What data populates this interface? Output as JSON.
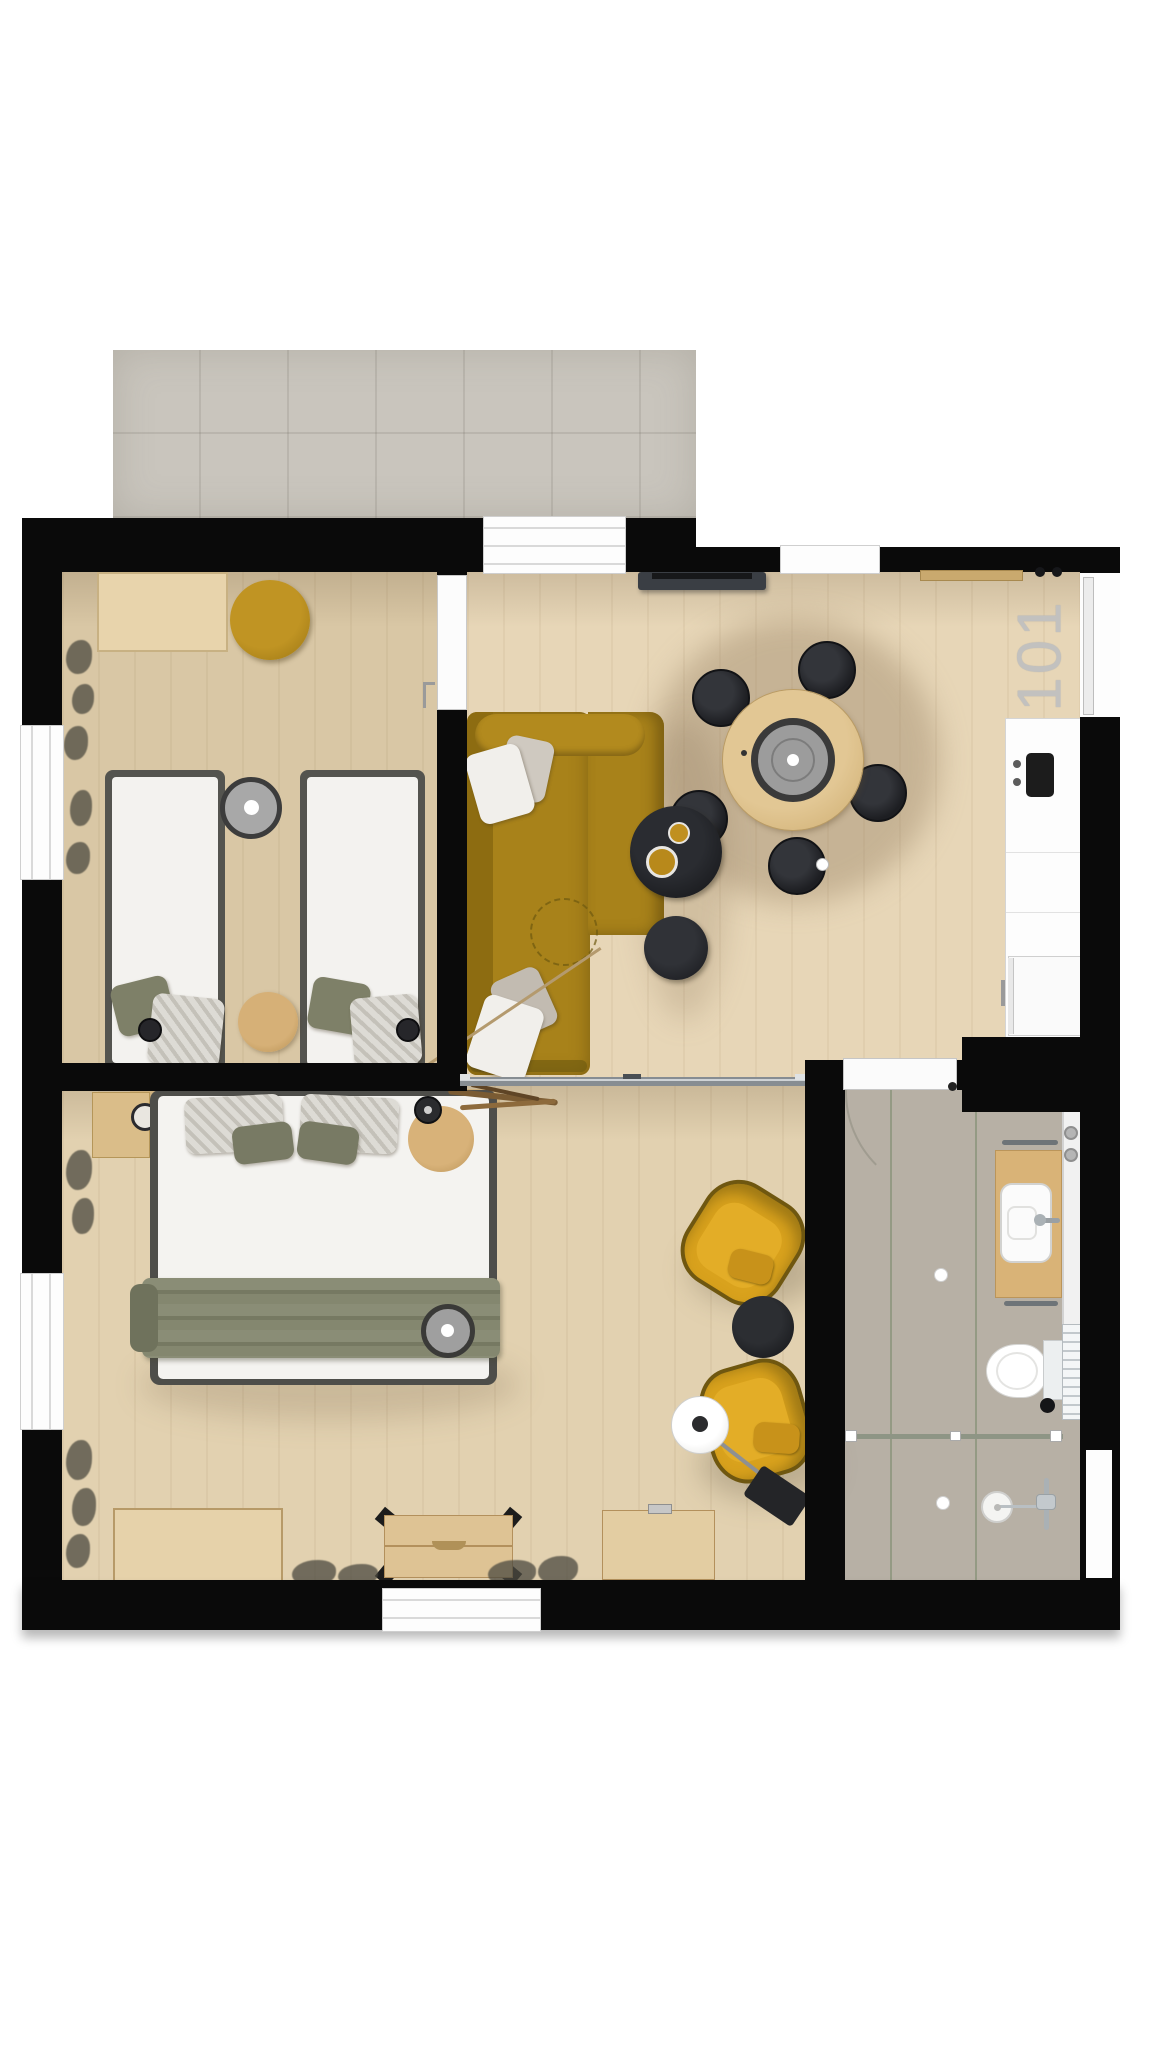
{
  "room_number": "101",
  "plan": {
    "type": "apartment-floor-plan-top-view",
    "rooms": [
      {
        "id": "balcony",
        "items": [
          "tile-terrace"
        ]
      },
      {
        "id": "bedroom-twin",
        "items": [
          "desk",
          "mustard-pouf",
          "single-bed-left",
          "single-bed-right",
          "olive-pillow",
          "striped-blanket",
          "reading-lamp",
          "round-gray-lamp",
          "wood-stool",
          "wall-plants",
          "window",
          "interior-door"
        ]
      },
      {
        "id": "living-dining",
        "items": [
          "tv-console",
          "entry-bench",
          "round-dining-table",
          "dining-chair-x5",
          "lazy-susan",
          "corner-sofa-mustard",
          "sofa-pillows",
          "decor-branch",
          "stitch-circle",
          "coffee-table-black-large",
          "coffee-table-black-small",
          "mustard-bowls",
          "balcony-door",
          "window",
          "entry-door"
        ]
      },
      {
        "id": "kitchen",
        "items": [
          "white-counter",
          "cooktop",
          "control-knobs",
          "fridge-cabinet"
        ]
      },
      {
        "id": "bedroom-double",
        "items": [
          "headboard-shelf",
          "nightstand-left",
          "nightstand-right",
          "bedside-lamp-x2",
          "double-bed",
          "striped-pillow-x2",
          "olive-pillow-x2",
          "olive-blanket",
          "round-gray-lamp",
          "storage-chest-a",
          "storage-chest-b",
          "storage-chest-c",
          "armchair-mustard-x2",
          "side-table-black",
          "floor-lamp-white",
          "round-side-table",
          "table-lamp-black",
          "driftwood-decor",
          "wall-plants",
          "window",
          "glass-partition"
        ]
      },
      {
        "id": "bathroom",
        "items": [
          "tile-floor",
          "vanity-counter",
          "vessel-sink",
          "faucet",
          "towel-bar-x2",
          "mirror-cabinet",
          "toiletries",
          "toilet",
          "towel-radiator",
          "grab-bar",
          "shower-glass-divider",
          "shower-drain",
          "shower-head",
          "ceiling-spotlight-x2",
          "bathroom-door",
          "wall-niche"
        ]
      }
    ],
    "colors": {
      "wall": "#0a0a0a",
      "wood_floor": "#e2d1b0",
      "balcony_tile": "#c9c5bd",
      "bath_tile": "#b7b0a5",
      "mustard": "#ad8418",
      "armchair_yellow": "#d9a21d",
      "bed_frame": "#50504b",
      "mattress": "#f4f3f0",
      "olive": "#7e8068",
      "table_wood": "#dcc08a",
      "chair_black": "#1d1e22",
      "glass": "#8f969b",
      "label_gray": "#c2c1bf"
    }
  }
}
